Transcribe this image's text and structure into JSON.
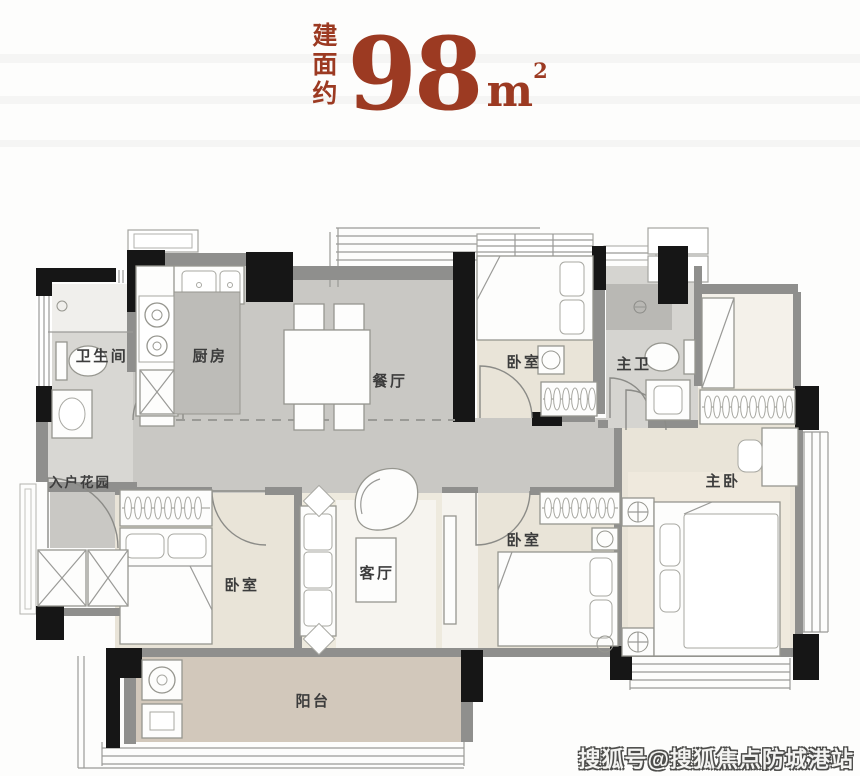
{
  "title": {
    "chars": [
      "建",
      "面",
      "约"
    ],
    "area": "98",
    "unit": "m",
    "unit_sup": "2"
  },
  "rooms": {
    "bathroom": "卫生间",
    "kitchen": "厨房",
    "dining": "餐厅",
    "bedroom_top": "卧室",
    "master_bath": "主卫",
    "entry_garden": "入户花园",
    "bedroom_left": "卧室",
    "living": "客厅",
    "bedroom_mid": "卧室",
    "master_bedroom": "主卧",
    "balcony": "阳台"
  },
  "watermark": {
    "text": "搜狐号@搜狐焦点防城港站"
  },
  "colors": {
    "accent_red": "#9c3a22",
    "wall_black": "#161616",
    "wall_gray": "#8f8f8d",
    "floor_gray": "#c9c8c4",
    "floor_light_gray": "#d8d7d3",
    "shower_gray": "#b9b8b4",
    "floor_beige": "#e9e4d8",
    "floor_balcony": "#d2c8bb",
    "label_text": "#3c3c3c"
  }
}
